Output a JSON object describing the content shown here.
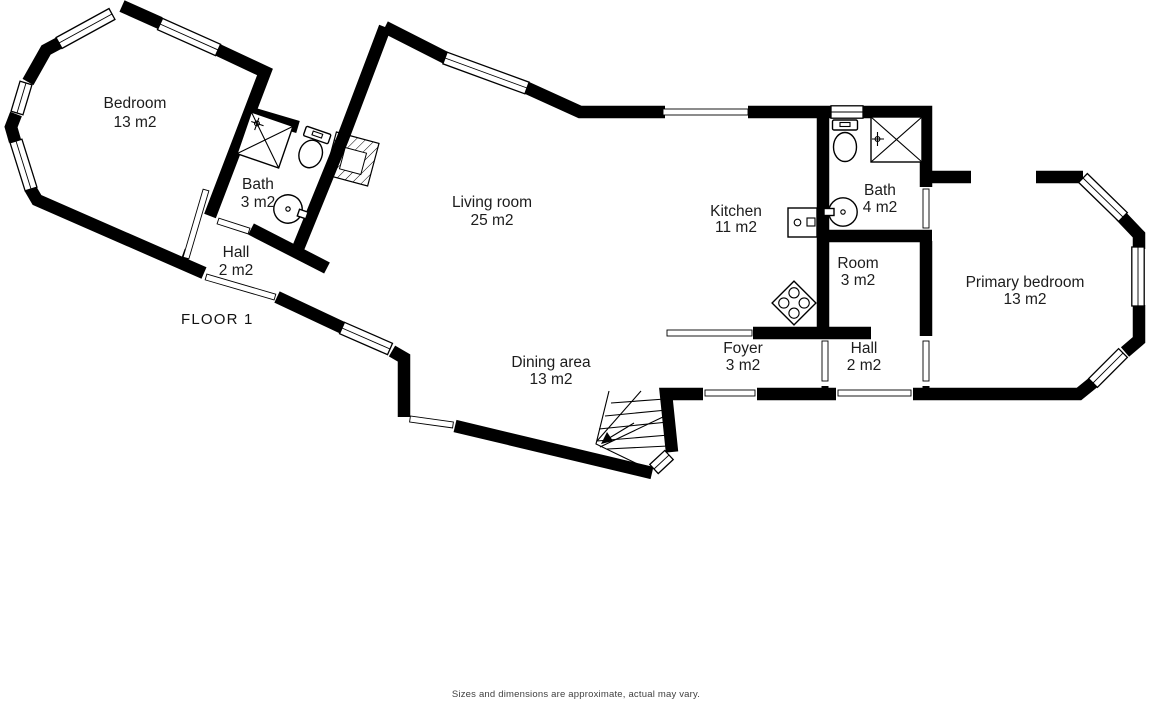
{
  "page": {
    "floor_label": "FLOOR 1",
    "disclaimer": "Sizes and dimensions are approximate, actual may vary."
  },
  "rooms": [
    {
      "name": "Bedroom",
      "area": "13 m2"
    },
    {
      "name": "Bath",
      "area": "3 m2"
    },
    {
      "name": "Hall",
      "area": "2 m2"
    },
    {
      "name": "Living room",
      "area": "25 m2"
    },
    {
      "name": "Dining area",
      "area": "13 m2"
    },
    {
      "name": "Kitchen",
      "area": "11 m2"
    },
    {
      "name": "Bath",
      "area": "4 m2"
    },
    {
      "name": "Room",
      "area": "3 m2"
    },
    {
      "name": "Hall",
      "area": "2 m2"
    },
    {
      "name": "Foyer",
      "area": "3 m2"
    },
    {
      "name": "Primary bedroom",
      "area": "13 m2"
    }
  ],
  "colors": {
    "wall": "#000000",
    "background": "#ffffff",
    "label_text": "#1c1c1c",
    "disclaimer_text": "#3f3f3f"
  }
}
